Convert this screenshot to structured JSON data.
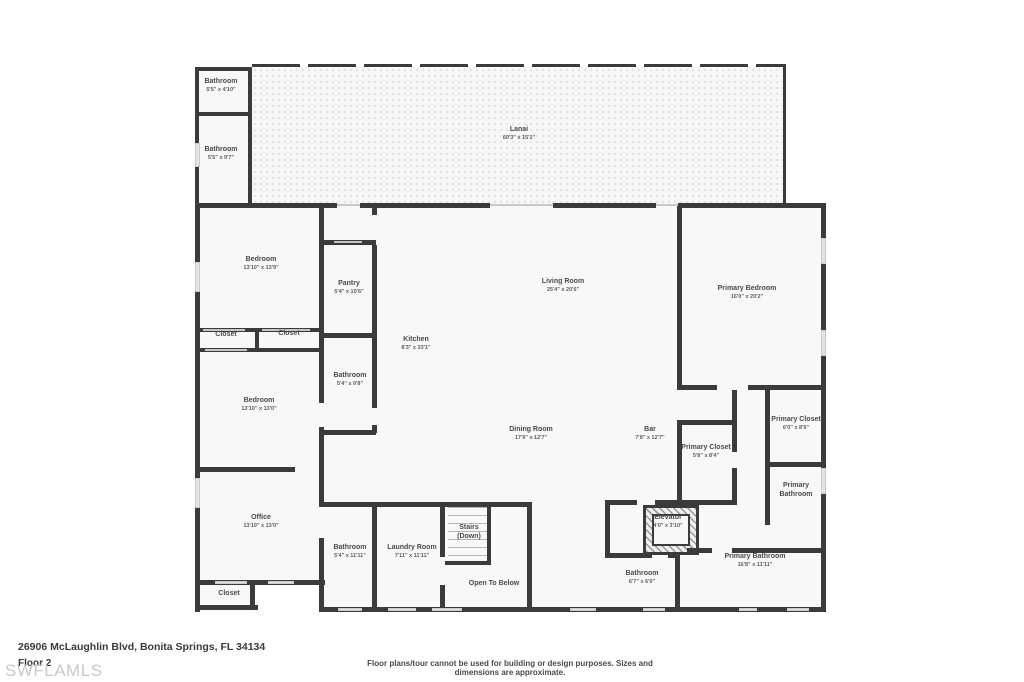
{
  "address": "26906 McLaughlin Blvd, Bonita Springs, FL 34134",
  "floor": "Floor 2",
  "watermark": "SWFLAMLS",
  "disclaimer": "Floor plans/tour cannot be used for building or design purposes. Sizes and dimensions are approximate.",
  "colors": {
    "wall": "#3b3b3b",
    "floor": "#f8f8f8",
    "label": "#4a4a4a"
  },
  "rooms": [
    {
      "name": "Bathroom",
      "dims": "5'5\" x 4'10\""
    },
    {
      "name": "Bathroom",
      "dims": "5'5\" x 9'7\""
    },
    {
      "name": "Lanai",
      "dims": "60'3\" x 15'1\""
    },
    {
      "name": "Bedroom",
      "dims": "13'10\" x 13'9\""
    },
    {
      "name": "Pantry",
      "dims": "5'4\" x 10'6\""
    },
    {
      "name": "Living Room",
      "dims": "25'4\" x 20'6\""
    },
    {
      "name": "Primary Bedroom",
      "dims": "16'0\" x 20'2\""
    },
    {
      "name": "Closet",
      "dims": ""
    },
    {
      "name": "Closet",
      "dims": ""
    },
    {
      "name": "Kitchen",
      "dims": "8'3\" x 33'1\""
    },
    {
      "name": "Bathroom",
      "dims": "5'4\" x 9'8\""
    },
    {
      "name": "Bedroom",
      "dims": "13'10\" x 13'0\""
    },
    {
      "name": "Dining Room",
      "dims": "17'9\" x 12'7\""
    },
    {
      "name": "Bar",
      "dims": "7'8\" x 12'7\""
    },
    {
      "name": "Primary Closet",
      "dims": "5'8\" x 8'4\""
    },
    {
      "name": "Primary Closet",
      "dims": "6'0\" x 8'9\""
    },
    {
      "name": "Primary Bathroom",
      "dims": ""
    },
    {
      "name": "Office",
      "dims": "13'10\" x 13'0\""
    },
    {
      "name": "Bathroom",
      "dims": "5'4\" x 11'11\""
    },
    {
      "name": "Laundry Room",
      "dims": "7'11\" x 11'11\""
    },
    {
      "name": "Stairs",
      "dims": "(Down)"
    },
    {
      "name": "Elevator",
      "dims": "4'0\" x 3'10\""
    },
    {
      "name": "Open To Below",
      "dims": ""
    },
    {
      "name": "Bathroom",
      "dims": "6'7\" x 6'0\""
    },
    {
      "name": "Primary Bathroom",
      "dims": "16'8\" x 11'11\""
    },
    {
      "name": "Closet",
      "dims": ""
    }
  ]
}
